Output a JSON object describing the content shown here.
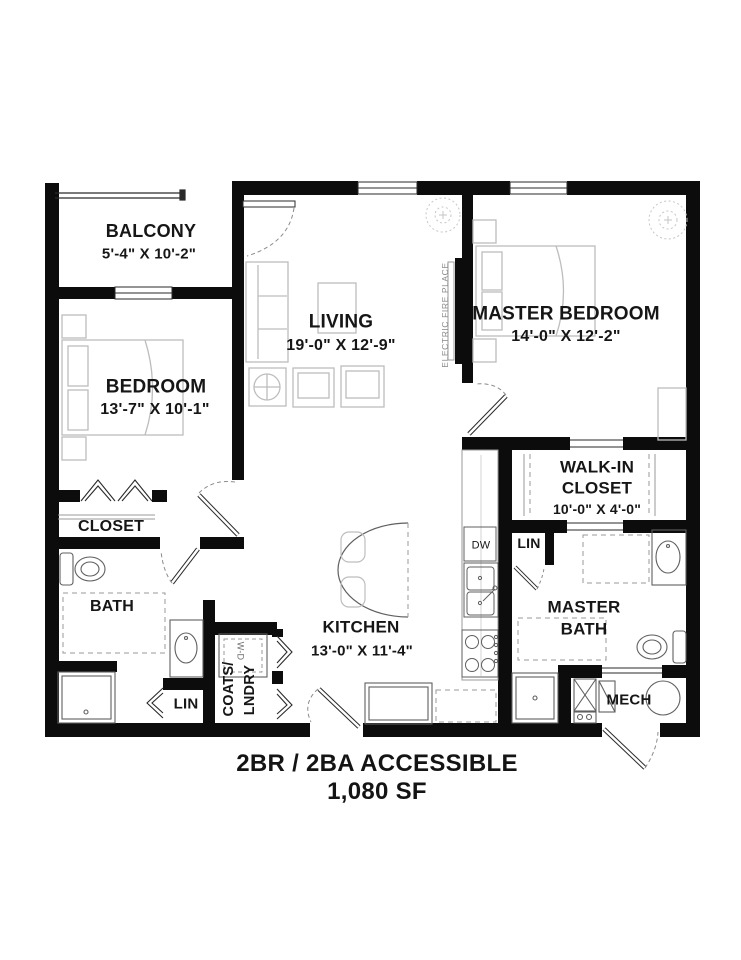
{
  "title": {
    "line1": "2BR / 2BA ACCESSIBLE",
    "line2": "1,080 SF"
  },
  "labels": {
    "balcony_name": "BALCONY",
    "balcony_dims": "5'-4\" X 10'-2\"",
    "bedroom_name": "BEDROOM",
    "bedroom_dims": "13'-7\" X 10'-1\"",
    "living_name": "LIVING",
    "living_dims": "19'-0\" X 12'-9\"",
    "master_bedroom_name": "MASTER BEDROOM",
    "master_bedroom_dims": "14'-0\" X 12'-2\"",
    "walk_in_line1": "WALK-IN",
    "walk_in_line2": "CLOSET",
    "walk_in_dims": "10'-0\" X 4'-0\"",
    "closet": "CLOSET",
    "bath": "BATH",
    "kitchen_name": "KITCHEN",
    "kitchen_dims": "13'-0\" X 11'-4\"",
    "master_bath_line1": "MASTER",
    "master_bath_line2": "BATH",
    "lin_hall": "LIN",
    "lin_master": "LIN",
    "dw": "DW",
    "mech": "MECH",
    "coats": "COATS/",
    "lndry": "LNDRY",
    "wd": "W-D",
    "fireplace": "ELECTRIC FIRE PLACE"
  },
  "colors": {
    "wall": "#0c0c0c",
    "thin_line": "#2a2a2a",
    "fixture": "#5f5f5f",
    "furniture": "#bdbdbd",
    "dash": "#9a9a9a",
    "text": "#161616",
    "muted_text": "#8a8a8a"
  }
}
